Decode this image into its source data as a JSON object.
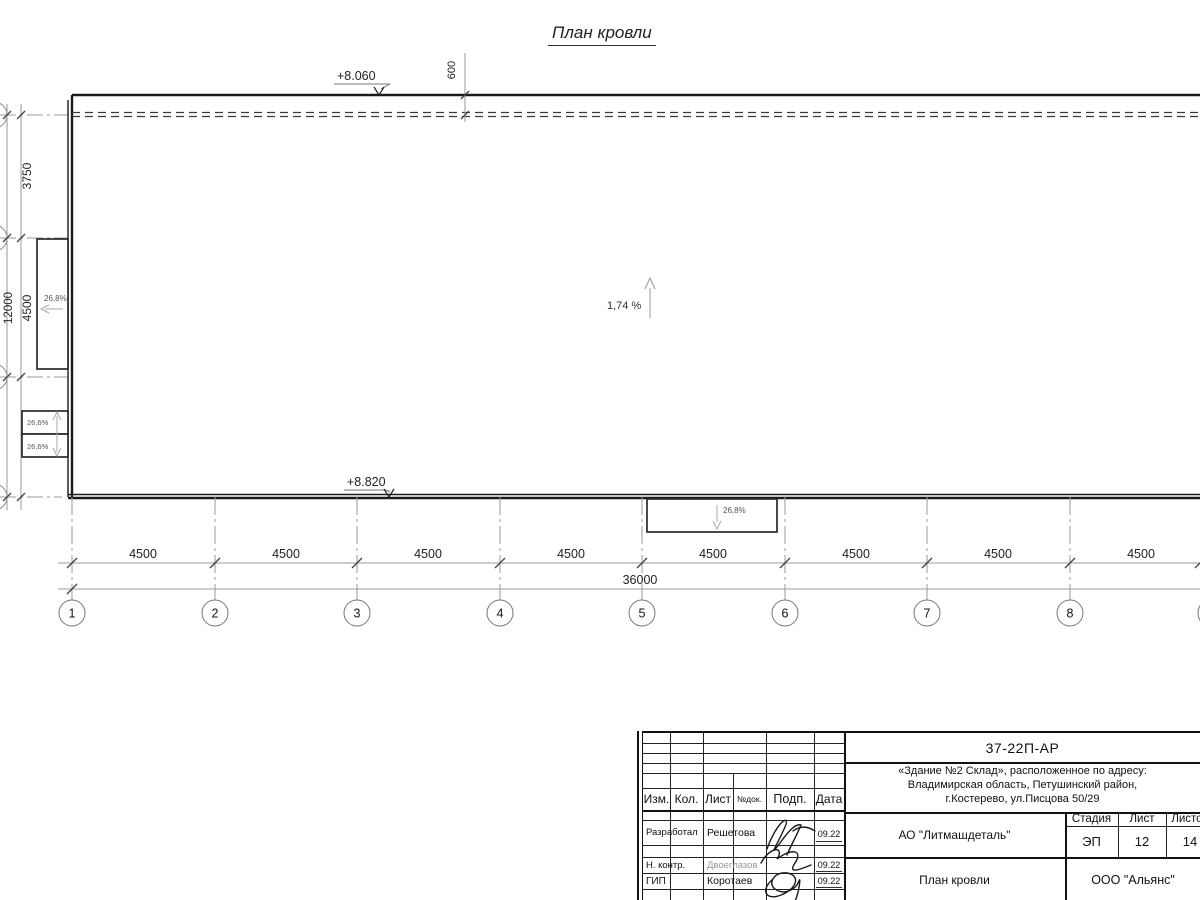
{
  "drawing": {
    "title": "План кровли",
    "elev_top": "+8.060",
    "elev_bottom": "+8.820",
    "parapet_dim": "600",
    "main_slope": "1,74 %",
    "left_canopy_slope": "26,8%",
    "left_box_top_slope": "26,6%",
    "left_box_bottom_slope": "26,6%",
    "bottom_canopy_slope": "26,8%",
    "left_dims": [
      "3750",
      "4500",
      "3750"
    ],
    "left_total": "12000",
    "bay_dims": [
      "4500",
      "4500",
      "4500",
      "4500",
      "4500",
      "4500",
      "4500",
      "4500"
    ],
    "total_dim": "36000",
    "axes": [
      "1",
      "2",
      "3",
      "4",
      "5",
      "6",
      "7",
      "8"
    ]
  },
  "titleblock": {
    "doc_number": "37-22П-АР",
    "address_lines": [
      "«Здание №2 Склад», расположенное по адресу:",
      "Владимирская область, Петушинский район,",
      "г.Костерево, ул.Писцова 50/29"
    ],
    "columns": {
      "izm": "Изм.",
      "kol": "Кол.",
      "list": "Лист",
      "ndok": "№док.",
      "podp": "Подп.",
      "data": "Дата"
    },
    "rows": [
      {
        "role": "Разработал",
        "name": "Решетова",
        "date": "09.22"
      },
      {
        "role": "Н. контр.",
        "name": "Двоеглазов",
        "date": "09.22"
      },
      {
        "role": "ГИП",
        "name": "Коротаев",
        "date": "09.22"
      }
    ],
    "company": "АО \"Литмашдеталь\"",
    "stage_label": "Стадия",
    "sheet_label": "Лист",
    "sheets_label": "Листов",
    "stage": "ЭП",
    "sheet": "12",
    "sheets": "14",
    "drawing_name": "План кровли",
    "org": "ООО \"Альянс\""
  }
}
